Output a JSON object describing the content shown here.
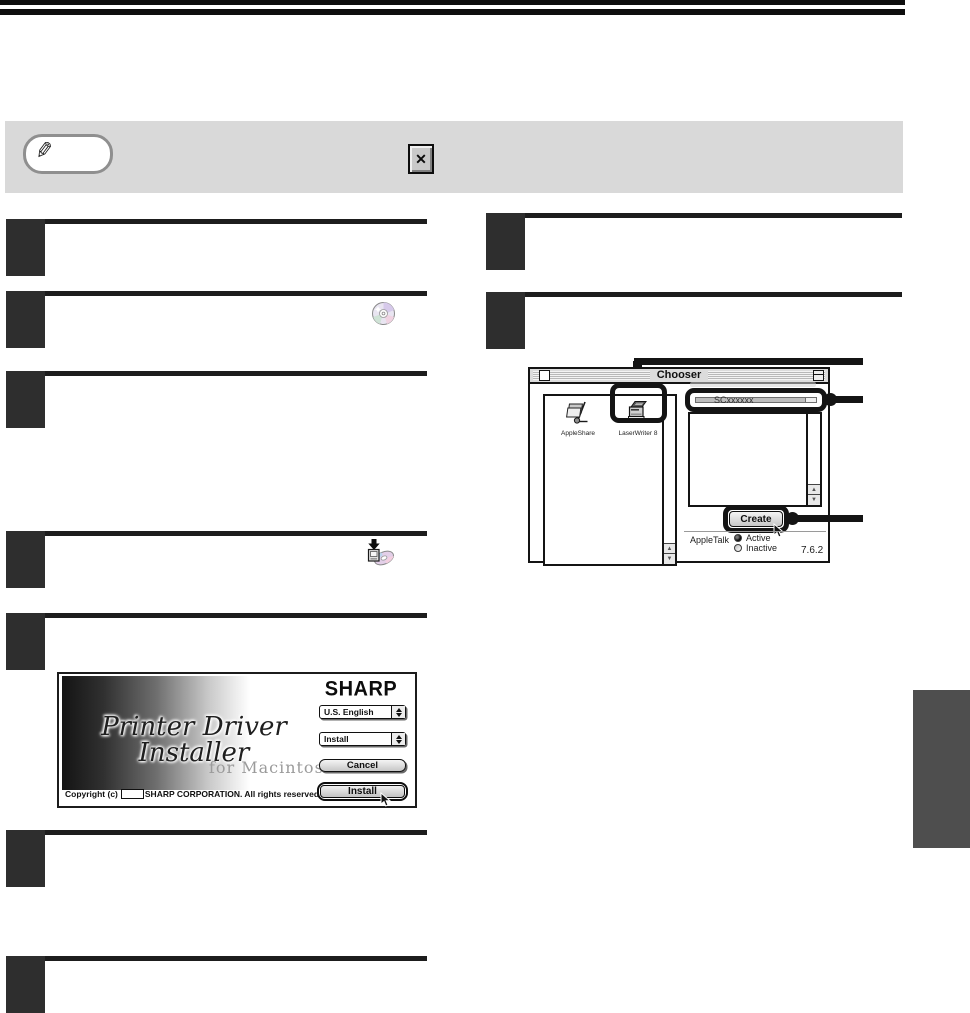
{
  "note": {
    "close_glyph": "✕"
  },
  "figure_chooser": {
    "title": "Chooser",
    "devices": [
      {
        "label": "AppleShare"
      },
      {
        "label": "LaserWriter 8"
      }
    ],
    "printer_list": {
      "rows": [
        {
          "name": "SCxxxxxx"
        }
      ]
    },
    "create_button": "Create",
    "appletalk_label": "AppleTalk",
    "radio_options": [
      {
        "label": "Active",
        "selected": true
      },
      {
        "label": "Inactive",
        "selected": false
      }
    ],
    "version": "7.6.2"
  },
  "figure_installer": {
    "brand": "SHARP",
    "title": "Printer Driver Installer",
    "subtitle": "for Macintosh",
    "language_select": "U.S. English",
    "action_select": "Install",
    "cancel_button": "Cancel",
    "install_button": "Install",
    "copyright_prefix": "Copyright (c)",
    "copyright_suffix": "SHARP CORPORATION. All rights reserved."
  }
}
